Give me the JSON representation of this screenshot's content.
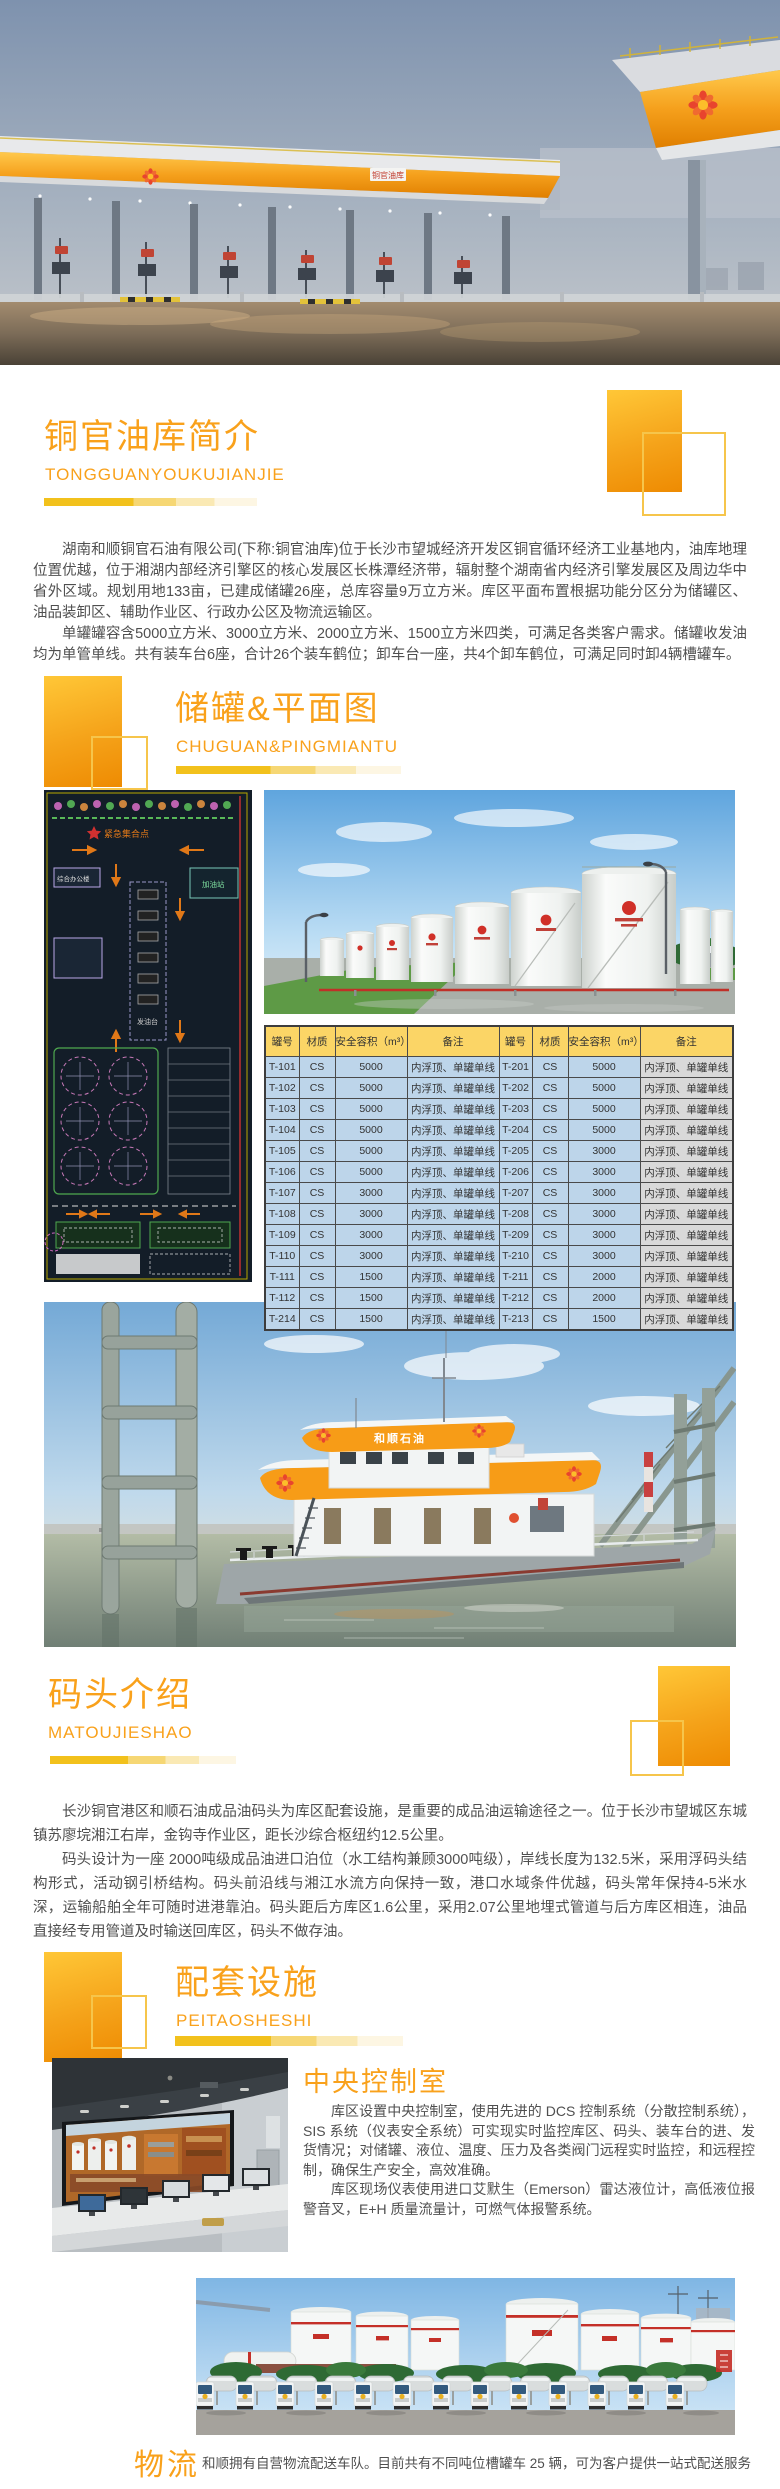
{
  "colors": {
    "accent_orange": "#F9A11B",
    "bar_yellow": "#F2C11C",
    "table_header_bg": "#FBD566",
    "table_cell_blue": "#BDD5EA",
    "table_cell_gray": "#D9D9D9",
    "body_text": "#4F4F4F"
  },
  "hero": {
    "sign_text": "铜官油库"
  },
  "sections": {
    "intro": {
      "title": "铜官油库简介",
      "subtitle": "TONGGUANYOUKUJIANJIE",
      "paragraphs": [
        "湖南和顺铜官石油有限公司(下称:铜官油库)位于长沙市望城经济开发区铜官循环经济工业基地内，油库地理位置优越，位于湘湖内部经济引擎区的核心发展区长株潭经济带，辐射整个湖南省内经济引擎发展区及周边华中省外区域。规划用地133亩，已建成储罐26座，总库容量9万立方米。库区平面布置根据功能分区分为储罐区、油品装卸区、辅助作业区、行政办公区及物流运输区。",
        "单罐罐容含5000立方米、3000立方米、2000立方米、1500立方米四类，可满足各类客户需求。储罐收发油均为单管单线。共有装车台6座，合计26个装车鹤位；卸车台一座，共4个卸车鹤位，可满足同时卸4辆槽罐车。"
      ]
    },
    "tanks": {
      "title": "储罐&平面图",
      "subtitle": "CHUGUAN&PINGMIANTU",
      "site_plan_labels": {
        "assembly_point": "紧急集合点",
        "office_building": "综合办公楼",
        "loading_island": "发油台",
        "gas_station": "加油站"
      },
      "table": {
        "headers": [
          "罐号",
          "材质",
          "安全容积（m³）",
          "备注",
          "罐号",
          "材质",
          "安全容积（m³）",
          "备注"
        ],
        "rows": [
          [
            "T-101",
            "CS",
            "5000",
            "内浮顶、单罐单线",
            "T-201",
            "CS",
            "5000",
            "内浮顶、单罐单线"
          ],
          [
            "T-102",
            "CS",
            "5000",
            "内浮顶、单罐单线",
            "T-202",
            "CS",
            "5000",
            "内浮顶、单罐单线"
          ],
          [
            "T-103",
            "CS",
            "5000",
            "内浮顶、单罐单线",
            "T-203",
            "CS",
            "5000",
            "内浮顶、单罐单线"
          ],
          [
            "T-104",
            "CS",
            "5000",
            "内浮顶、单罐单线",
            "T-204",
            "CS",
            "5000",
            "内浮顶、单罐单线"
          ],
          [
            "T-105",
            "CS",
            "5000",
            "内浮顶、单罐单线",
            "T-205",
            "CS",
            "3000",
            "内浮顶、单罐单线"
          ],
          [
            "T-106",
            "CS",
            "5000",
            "内浮顶、单罐单线",
            "T-206",
            "CS",
            "3000",
            "内浮顶、单罐单线"
          ],
          [
            "T-107",
            "CS",
            "3000",
            "内浮顶、单罐单线",
            "T-207",
            "CS",
            "3000",
            "内浮顶、单罐单线"
          ],
          [
            "T-108",
            "CS",
            "3000",
            "内浮顶、单罐单线",
            "T-208",
            "CS",
            "3000",
            "内浮顶、单罐单线"
          ],
          [
            "T-109",
            "CS",
            "3000",
            "内浮顶、单罐单线",
            "T-209",
            "CS",
            "3000",
            "内浮顶、单罐单线"
          ],
          [
            "T-110",
            "CS",
            "3000",
            "内浮顶、单罐单线",
            "T-210",
            "CS",
            "3000",
            "内浮顶、单罐单线"
          ],
          [
            "T-111",
            "CS",
            "1500",
            "内浮顶、单罐单线",
            "T-211",
            "CS",
            "2000",
            "内浮顶、单罐单线"
          ],
          [
            "T-112",
            "CS",
            "1500",
            "内浮顶、单罐单线",
            "T-212",
            "CS",
            "2000",
            "内浮顶、单罐单线"
          ],
          [
            "T-214",
            "CS",
            "1500",
            "内浮顶、单罐单线",
            "T-213",
            "CS",
            "1500",
            "内浮顶、单罐单线"
          ]
        ]
      }
    },
    "dock": {
      "title": "码头介绍",
      "subtitle": "MATOUJIESHAO",
      "ship_brand": "和顺石油",
      "paragraphs": [
        "长沙铜官港区和顺石油成品油码头为库区配套设施，是重要的成品油运输途径之一。位于长沙市望城区东城镇苏廖垸湘江右岸，金钩寺作业区，距长沙综合枢纽约12.5公里。",
        "码头设计为一座 2000吨级成品油进口泊位（水工结构兼顾3000吨级），岸线长度为132.5米，采用浮码头结构形式，活动钢引桥结构。码头前沿线与湘江水流方向保持一致，港口水域条件优越，码头常年保持4-5米水深，运输船舶全年可随时进港靠泊。码头距后方库区1.6公里，采用2.07公里地埋式管道与后方库区相连，油品直接经专用管道及时输送回库区，码头不做存油。"
      ]
    },
    "facilities": {
      "title": "配套设施",
      "subtitle": "PEITAOSHESHI"
    },
    "control_room": {
      "title": "中央控制室",
      "paragraphs": [
        "库区设置中央控制室，使用先进的 DCS 控制系统（分散控制系统），SIS 系统（仪表安全系统）可实现实时监控库区、码头、装车台的进、发货情况；对储罐、液位、温度、压力及各类阀门远程实时监控，和远程控制，确保生产安全，高效准确。",
        "库区现场仪表使用进口艾默生（Emerson）雷达液位计，高低液位报警音叉，E+H 质量流量计，可燃气体报警系统。"
      ]
    },
    "logistics": {
      "label": "物流",
      "text": "和顺拥有自营物流配送车队。目前共有不同吨位槽罐车 25 辆，可为客户提供一站式配送服务"
    }
  }
}
